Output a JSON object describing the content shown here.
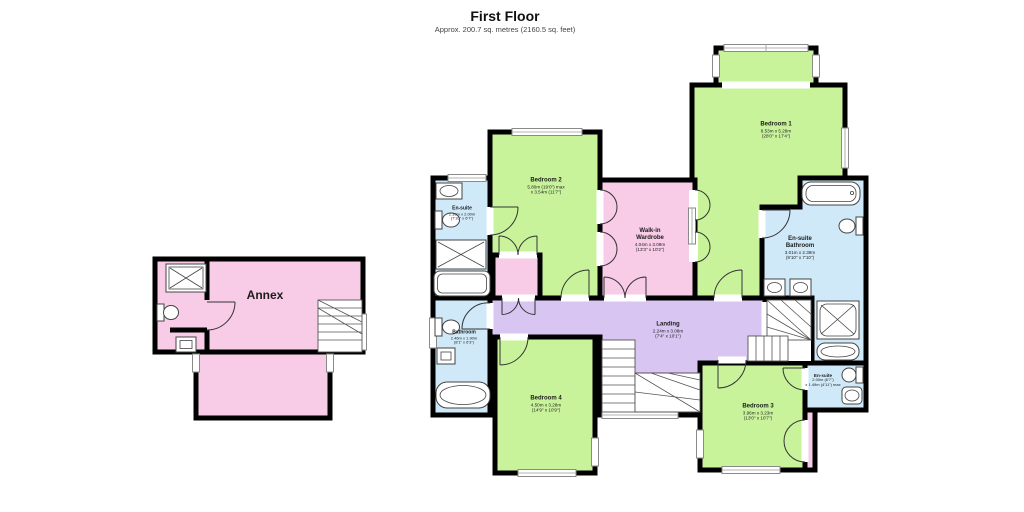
{
  "title": {
    "heading": "First Floor",
    "subheading": "Approx. 200.7 sq. metres (2160.5 sq. feet)"
  },
  "colors": {
    "bedroom": "#c9f39b",
    "bath": "#cfe9f8",
    "pink": "#f8cbe7",
    "landing": "#d8c5f2",
    "stairs": "#ffffff",
    "wall": "#000000"
  },
  "rooms": {
    "bedroom1": {
      "name": "Bedroom 1",
      "dim_m": "8.53m x 5.28m",
      "dim_ft": "(28'0\" x 17'4\")"
    },
    "bedroom2": {
      "name": "Bedroom 2",
      "dim_m": "5.80m (19'0\") max",
      "dim_ft": "x 3.54m (11'7\")"
    },
    "bedroom3": {
      "name": "Bedroom 3",
      "dim_m": "3.96m x 3.23m",
      "dim_ft": "(13'0\" x 10'7\")"
    },
    "bedroom4": {
      "name": "Bedroom 4",
      "dim_m": "4.50m x 3.28m",
      "dim_ft": "(14'9\" x 10'9\")"
    },
    "ensuite_top": {
      "name": "En-suite",
      "dim_m": "2.39m x 2.00m",
      "dim_ft": "(7'10\" x 6'7\")"
    },
    "bathroom": {
      "name": "Bathroom",
      "dim_m": "2.46m x 1.90m",
      "dim_ft": "(8'1\" x 6'3\")"
    },
    "wardrobe": {
      "name": "Walk-in",
      "name2": "Wardrobe",
      "dim_m": "4.04m x 3.09m",
      "dim_ft": "(13'3\" x 10'2\")"
    },
    "ensuite_bathroom": {
      "name": "En-suite",
      "name2": "Bathroom",
      "dim_m": "3.01m x 2.39m",
      "dim_ft": "(9'10\" x 7'10\")"
    },
    "landing": {
      "name": "Landing",
      "dim_m": "2.24m x 3.08m",
      "dim_ft": "(7'4\" x 10'1\")"
    },
    "ensuite_bed3": {
      "name": "En-suite",
      "dim_m": "2.00m (6'7\")",
      "dim_ft": "x 1.49m (4'11\") max"
    },
    "annex": {
      "name": "Annex"
    }
  }
}
